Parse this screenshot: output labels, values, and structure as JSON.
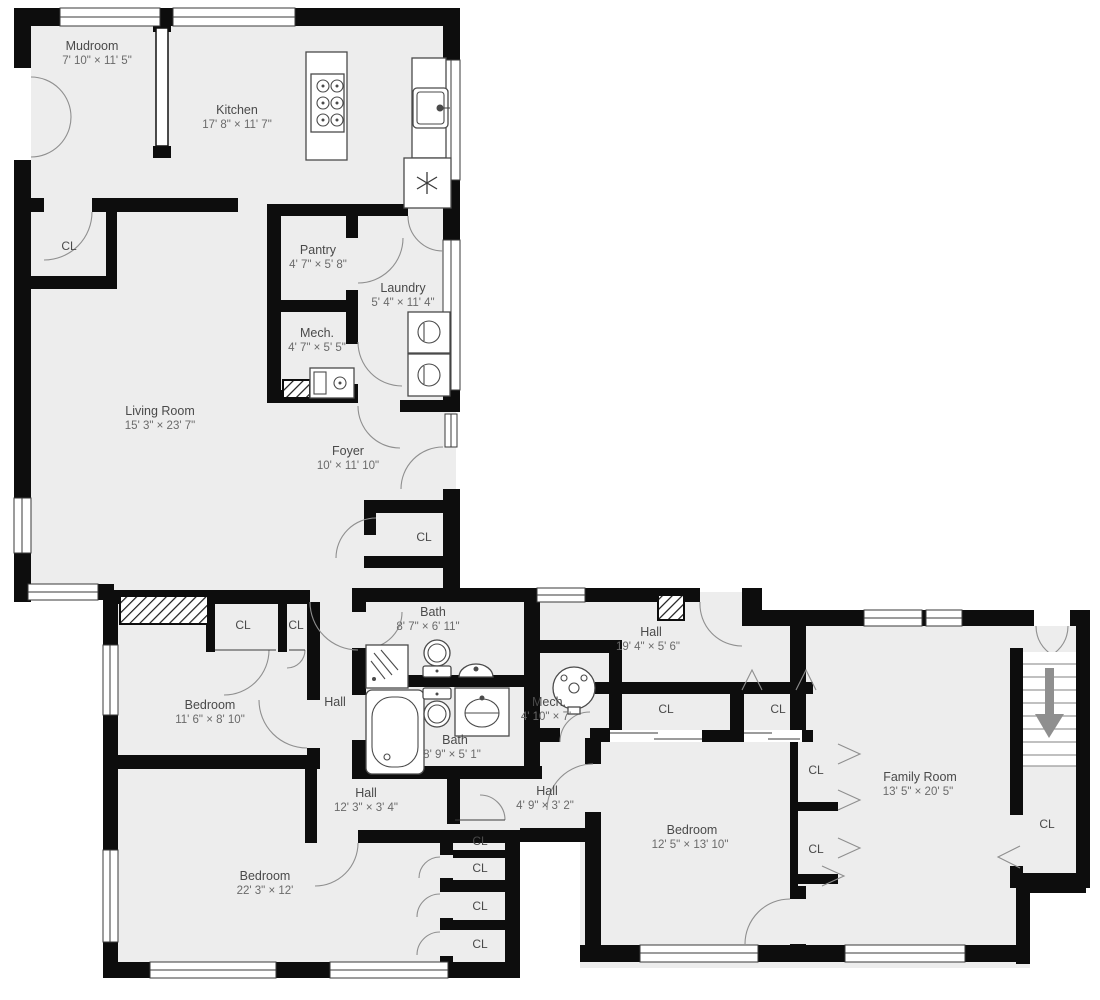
{
  "plan": {
    "closet_label": "CL",
    "stair_direction": "down",
    "colors": {
      "floor": "#ededed",
      "wall": "#0d0d0d",
      "room_name_text": "#4a4a4a",
      "room_dims_text": "#6a6a6a",
      "door_arc": "#8f8f8f",
      "stair_arrow": "#8f8f8f"
    },
    "rooms": [
      {
        "name": "Mudroom",
        "dims": "7' 10\" × 11' 5\""
      },
      {
        "name": "Kitchen",
        "dims": "17' 8\" × 11' 7\""
      },
      {
        "name": "Pantry",
        "dims": "4' 7\" × 5' 8\""
      },
      {
        "name": "Laundry",
        "dims": "5' 4\" × 11' 4\""
      },
      {
        "name": "Mech.",
        "dims": "4' 7\" × 5' 5\""
      },
      {
        "name": "Living Room",
        "dims": "15' 3\" × 23' 7\""
      },
      {
        "name": "Foyer",
        "dims": "10' × 11' 10\""
      },
      {
        "name": "Bath",
        "dims": "8' 7\" × 6' 11\""
      },
      {
        "name": "Hall",
        "dims": "19' 4\" × 5' 6\""
      },
      {
        "name": "Bedroom",
        "dims": "11' 6\" × 8' 10\""
      },
      {
        "name": "Hall",
        "dims": ""
      },
      {
        "name": "Mech.",
        "dims": "4' 10\" × 7'"
      },
      {
        "name": "Bath",
        "dims": "8' 9\" × 5' 1\""
      },
      {
        "name": "Hall",
        "dims": "12' 3\" × 3' 4\""
      },
      {
        "name": "Hall",
        "dims": "4' 9\" × 3' 2\""
      },
      {
        "name": "Bedroom",
        "dims": "22' 3\" × 12'"
      },
      {
        "name": "Bedroom",
        "dims": "12' 5\" × 13' 10\""
      },
      {
        "name": "Family Room",
        "dims": "13' 5\" × 20' 5\""
      }
    ],
    "fixtures": [
      "stove",
      "kitchen-sink",
      "refrigerator",
      "washer",
      "dryer",
      "furnace",
      "shower",
      "toilet",
      "pedestal-sink",
      "bathtub",
      "vanity-sink",
      "water-heater",
      "stairs",
      "chimney"
    ]
  }
}
